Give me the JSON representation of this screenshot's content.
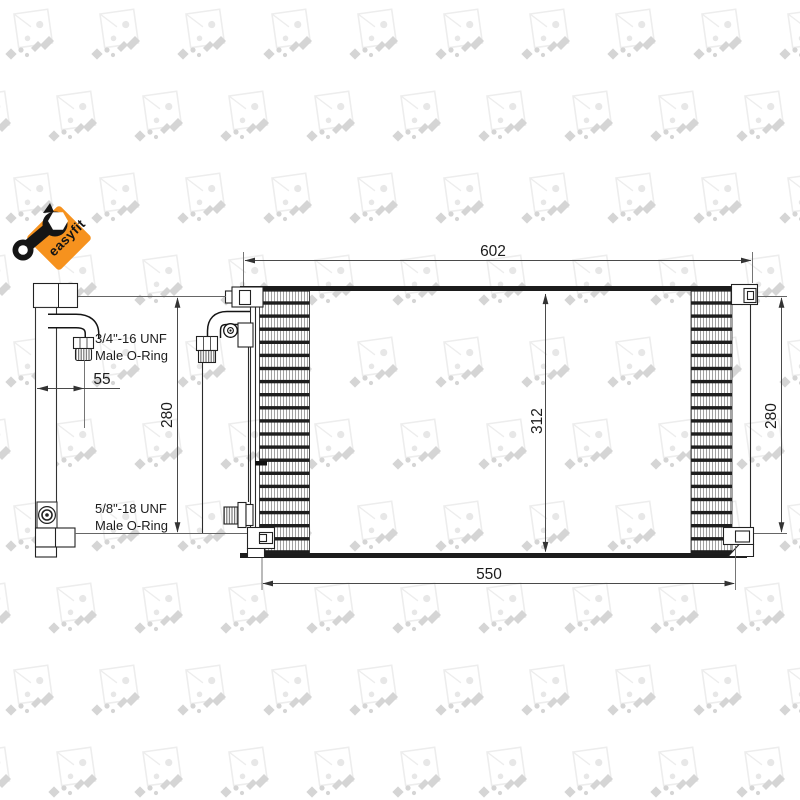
{
  "drawing": {
    "type": "technical-drawing",
    "product": "condenser",
    "dimensions": {
      "overall_width": "602",
      "mounting_width": "550",
      "left_height": "280",
      "right_height": "280",
      "core_height": "312",
      "fitting_offset": "55"
    },
    "fittings": {
      "top": {
        "line1": "3/4\"-16 UNF",
        "line2": "Male O-Ring"
      },
      "bottom": {
        "line1": "5/8\"-18 UNF",
        "line2": "Male O-Ring"
      }
    }
  },
  "logo": {
    "label": "easyfit",
    "bg_color": "#f6921e",
    "icon": "wrench-icon"
  },
  "watermark": {
    "brand": "NRF",
    "square_color": "#ededed",
    "glyph_color": "#d5d5d5"
  }
}
